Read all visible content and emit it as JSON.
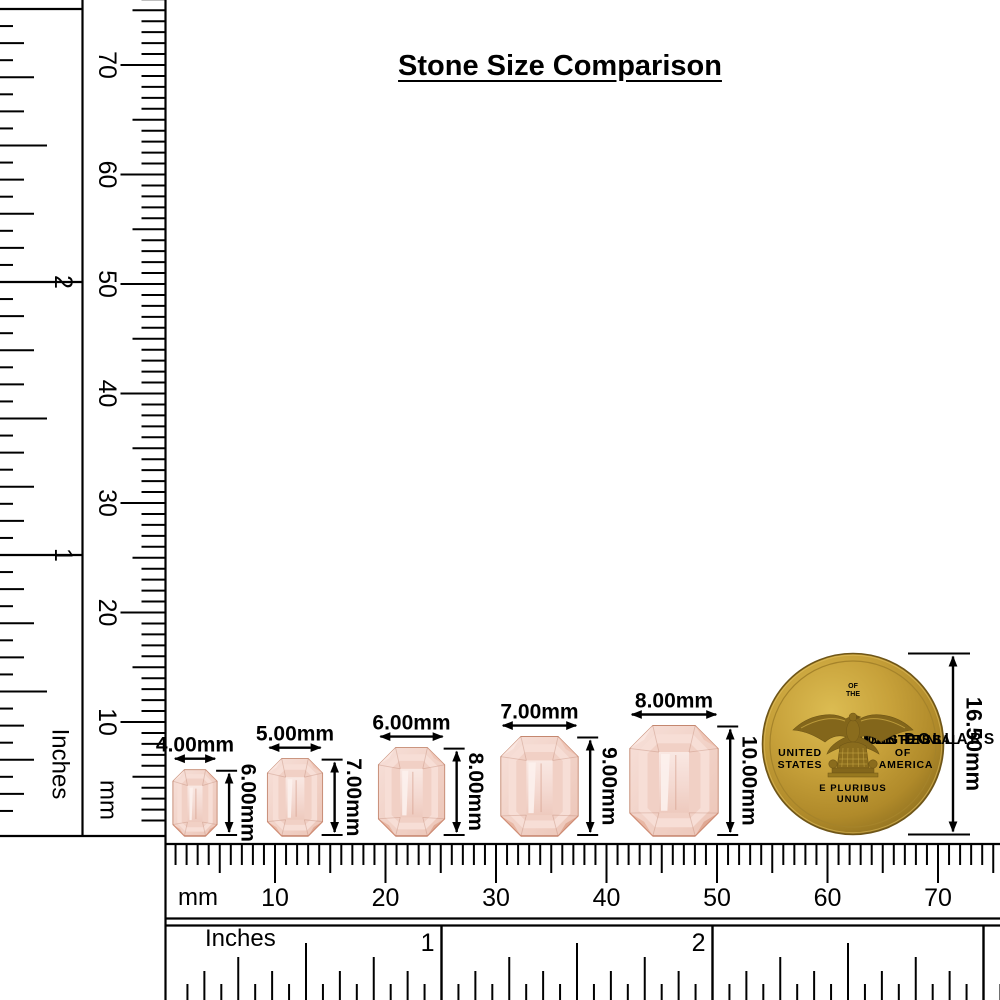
{
  "title": "Stone Size Comparison",
  "rulers": {
    "left_inches": {
      "unit": "Inches",
      "tick_labels": [
        "1",
        "2"
      ]
    },
    "left_mm": {
      "unit": "mm",
      "tick_labels": [
        "10",
        "20",
        "30",
        "40",
        "50",
        "60",
        "70"
      ]
    },
    "bottom_mm": {
      "unit": "mm",
      "tick_labels": [
        "10",
        "20",
        "30",
        "40",
        "50",
        "60",
        "70"
      ]
    },
    "bottom_inches": {
      "unit": "Inches",
      "tick_labels": [
        "1",
        "2"
      ]
    }
  },
  "stones": [
    {
      "width_mm": 4,
      "height_mm": 6,
      "width_label": "4.00mm",
      "height_label": "6.00mm"
    },
    {
      "width_mm": 5,
      "height_mm": 7,
      "width_label": "5.00mm",
      "height_label": "7.00mm"
    },
    {
      "width_mm": 6,
      "height_mm": 8,
      "width_label": "6.00mm",
      "height_label": "8.00mm"
    },
    {
      "width_mm": 7,
      "height_mm": 9,
      "width_label": "7.00mm",
      "height_label": "9.00mm"
    },
    {
      "width_mm": 8,
      "height_mm": 10,
      "width_label": "8.00mm",
      "height_label": "10.00mm"
    }
  ],
  "coin": {
    "diameter_mm": 16.5,
    "diameter_label": "16.50mm",
    "texts": {
      "arc_left": "BICENTENNIAL",
      "top_small_1": "OF",
      "top_small_2": "THE",
      "arc_right": "CONGRESS",
      "left_line_1": "UNITED",
      "left_line_2": "STATES",
      "right_line_1": "OF",
      "right_line_2": "AMERICA",
      "motto_line_1": "E PLURIBUS",
      "motto_line_2": "UNUM",
      "arc_bottom": "FIVE DOLLARS"
    }
  },
  "colors": {
    "ink": "#000000",
    "stone_base": "#f3d6cc",
    "stone_light": "#fbeee9",
    "stone_edge": "#c4876f",
    "stone_dark": "#d9987f",
    "coin_gold": "#c7a13a",
    "coin_gold_dark": "#8f701f",
    "coin_letters": "#ecd47f"
  }
}
